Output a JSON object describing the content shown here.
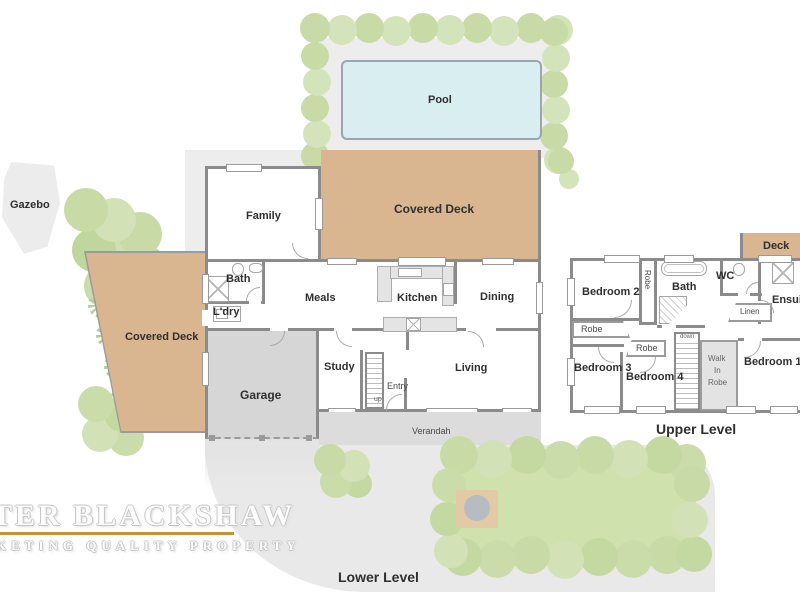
{
  "lower_level": {
    "label": "Lower Level",
    "rooms": {
      "pool": "Pool",
      "covered_deck": "Covered Deck",
      "covered_deck_side": "Covered Deck",
      "gazebo": "Gazebo",
      "family": "Family",
      "bath": "Bath",
      "laundry": "L'dry",
      "meals": "Meals",
      "kitchen": "Kitchen",
      "dining": "Dining",
      "study": "Study",
      "entry": "Entry",
      "living": "Living",
      "garage": "Garage",
      "verandah": "Verandah"
    },
    "stairs": {
      "up": "up"
    }
  },
  "upper_level": {
    "label": "Upper Level",
    "rooms": {
      "bedroom1": "Bedroom 1",
      "bedroom2": "Bedroom 2",
      "bedroom3": "Bedroom 3",
      "bedroom4": "Bedroom 4",
      "bath": "Bath",
      "wc": "WC",
      "ensuite": "Ensuite",
      "deck": "Deck",
      "linen": "Linen",
      "robe_hall_vertical": "Robe",
      "robe_bedroom2": "Robe",
      "robe_bedroom4": "Robe",
      "walk_in_robe": {
        "line1": "Walk",
        "line2": "In",
        "line3": "Robe"
      }
    },
    "stairs": {
      "down": "down"
    }
  },
  "watermark": {
    "line1": "TER BLACKSHAW",
    "line2": "KETING QUALITY PROPERTY",
    "rule_color": "#c79136"
  },
  "colors": {
    "wall": "#8b8b8b",
    "deck": "#d9b690",
    "pool_water": "#d9eef1",
    "paving": "#ededed",
    "hedge": "#c8dba6",
    "lawn": "#cfe2ae",
    "garage_floor": "#d6d6d6",
    "verandah": "#dcdcdc",
    "ground": "#e9e9e9"
  }
}
